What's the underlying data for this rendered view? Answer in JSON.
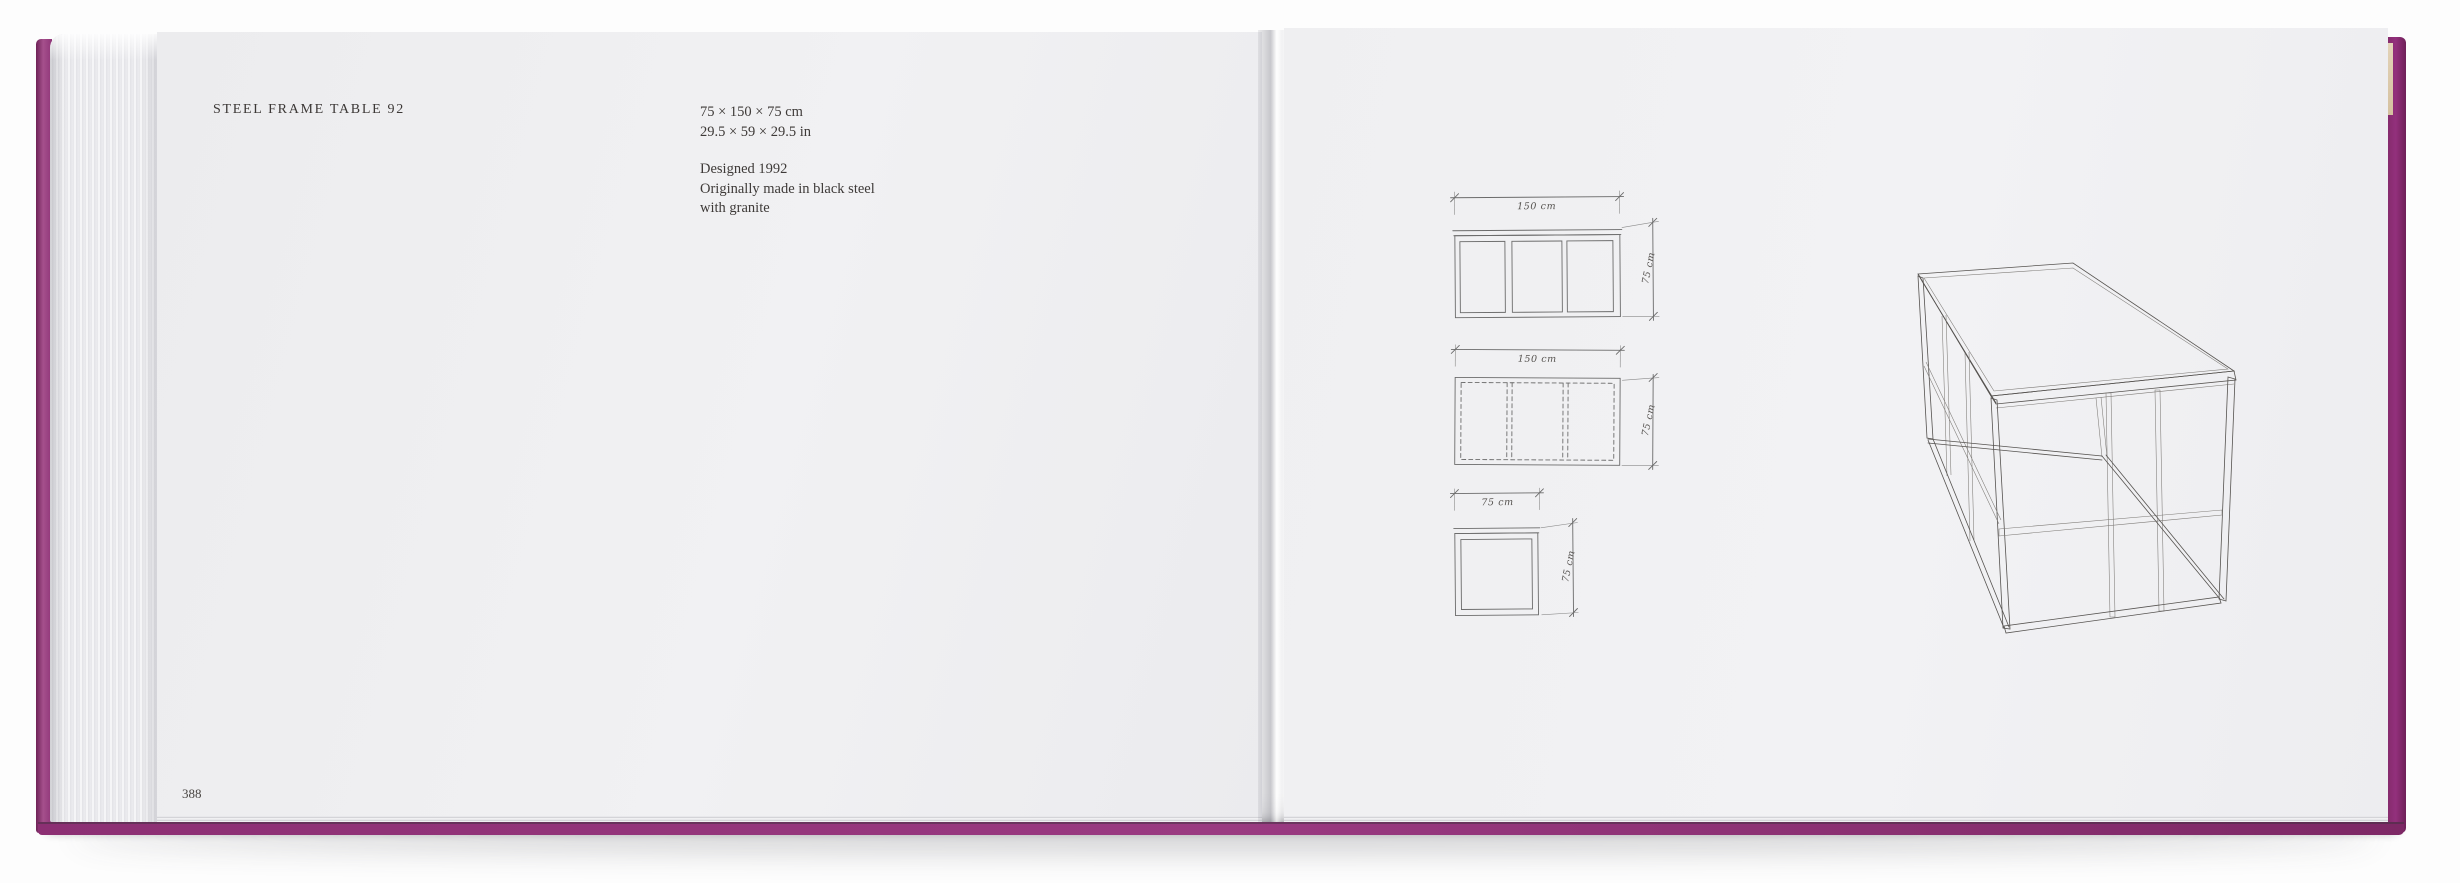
{
  "book": {
    "cover_color": "#8f3277",
    "left_page": {
      "title": "STEEL FRAME TABLE 92",
      "dimensions_cm": "75 × 150 × 75 cm",
      "dimensions_in": "29.5 × 59 × 29.5 in",
      "design_line1": "Designed 1992",
      "design_line2": "Originally made in black steel",
      "design_line3": "with granite",
      "page_number": "388"
    },
    "right_page": {
      "front_view": {
        "width_label": "150 cm",
        "height_label": "75 cm"
      },
      "plan_view": {
        "width_label": "150 cm",
        "depth_label": "75 cm"
      },
      "side_view": {
        "width_label": "75 cm",
        "height_label": "75 cm"
      }
    }
  }
}
